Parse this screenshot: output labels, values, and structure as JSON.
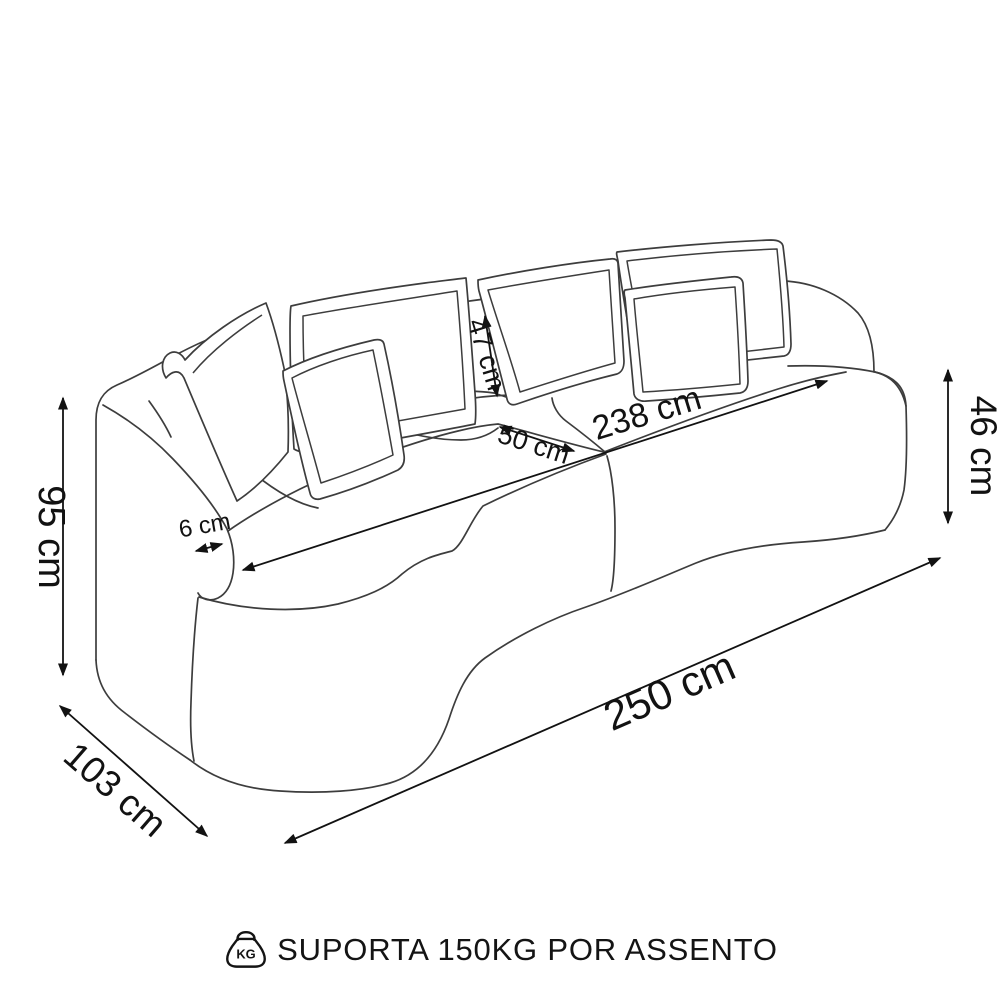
{
  "diagram": {
    "kind": "furniture-dimension-drawing",
    "subject": "curved-two-seat-sofa-with-six-pillows",
    "dimensions": {
      "height": "95 cm",
      "depth": "103 cm",
      "overall_width": "250 cm",
      "seat_width": "238 cm",
      "seat_depth": "50 cm",
      "back_pillow_height": "47 cm",
      "base_height": "46 cm",
      "armrest_thickness": "6 cm"
    },
    "caption": {
      "kg_icon_label": "KG",
      "text": "SUPORTA 150KG POR ASSENTO"
    },
    "colors": {
      "line": "#3d3d3d",
      "dimension": "#121212",
      "background": "#ffffff"
    }
  }
}
